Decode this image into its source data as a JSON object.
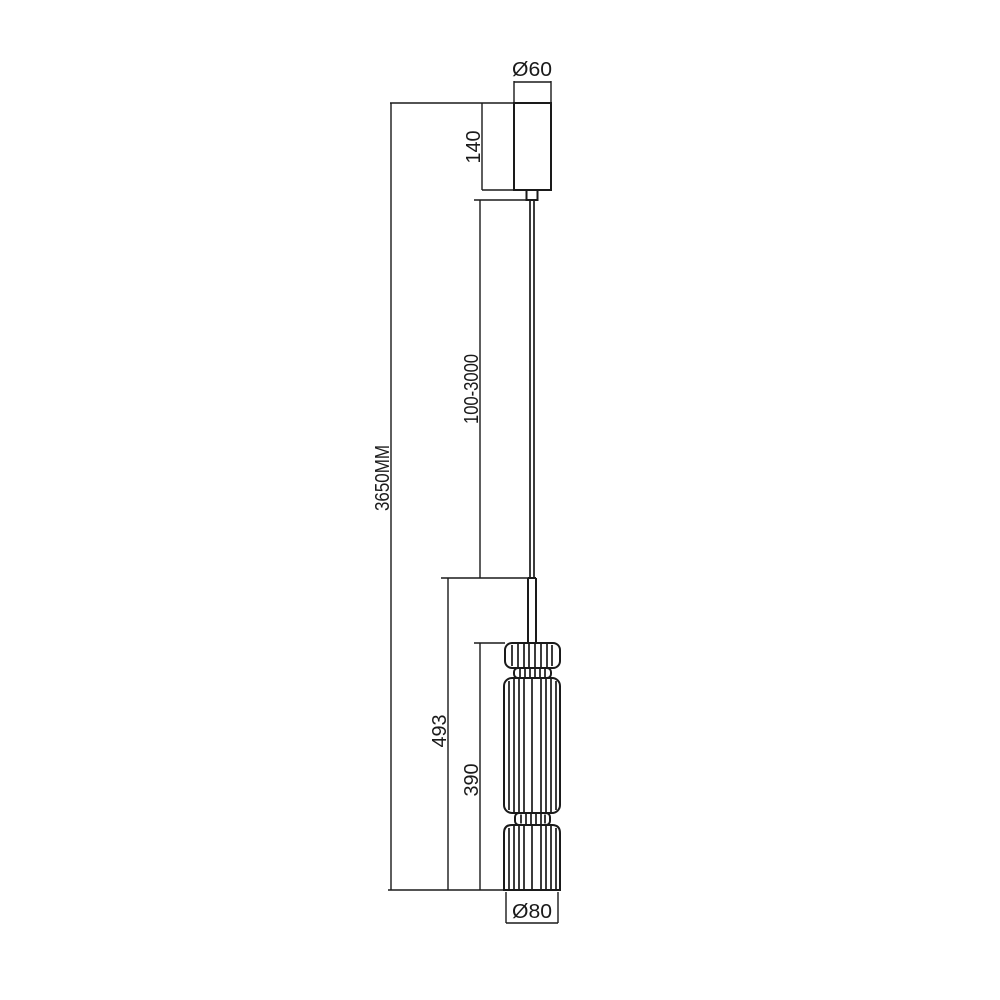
{
  "drawing": {
    "background_color": "#ffffff",
    "line_color": "#1a1a1a",
    "labels": {
      "canopy_diameter": "Ø60",
      "canopy_height": "140",
      "suspension_length": "100-3000",
      "total_height": "3650MM",
      "body_assembly_height": "493",
      "shade_height": "390",
      "shade_diameter": "Ø80"
    }
  }
}
